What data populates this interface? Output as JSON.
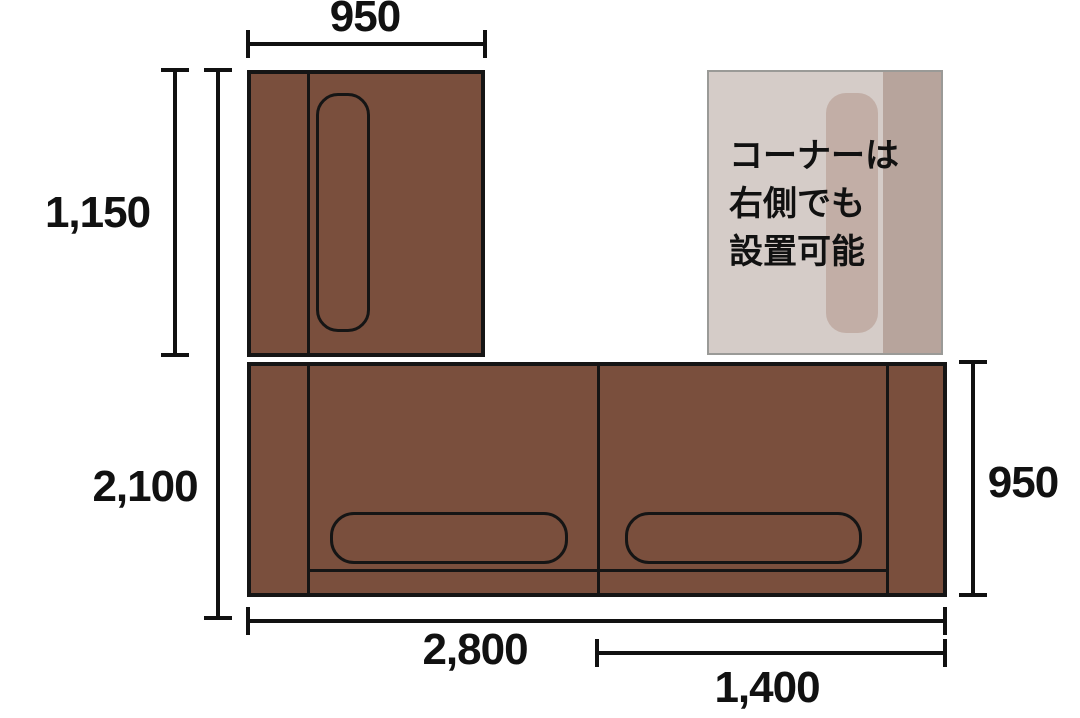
{
  "labels": {
    "top_width": "950",
    "corner_depth": "1,150",
    "total_depth": "2,100",
    "total_width": "2,800",
    "right_width": "1,400",
    "right_depth": "950"
  },
  "note": {
    "line1": "コーナーは",
    "line2": "右側でも",
    "line3": "設置可能"
  },
  "colors": {
    "sofa": "#7a4f3d",
    "outline": "#151515",
    "ghost_body": "#d5ccc8",
    "ghost_armrest": "#b7a49c",
    "ghost_cushion": "#c2aea6",
    "ghost_border": "#9a9a97",
    "text": "#111111"
  }
}
